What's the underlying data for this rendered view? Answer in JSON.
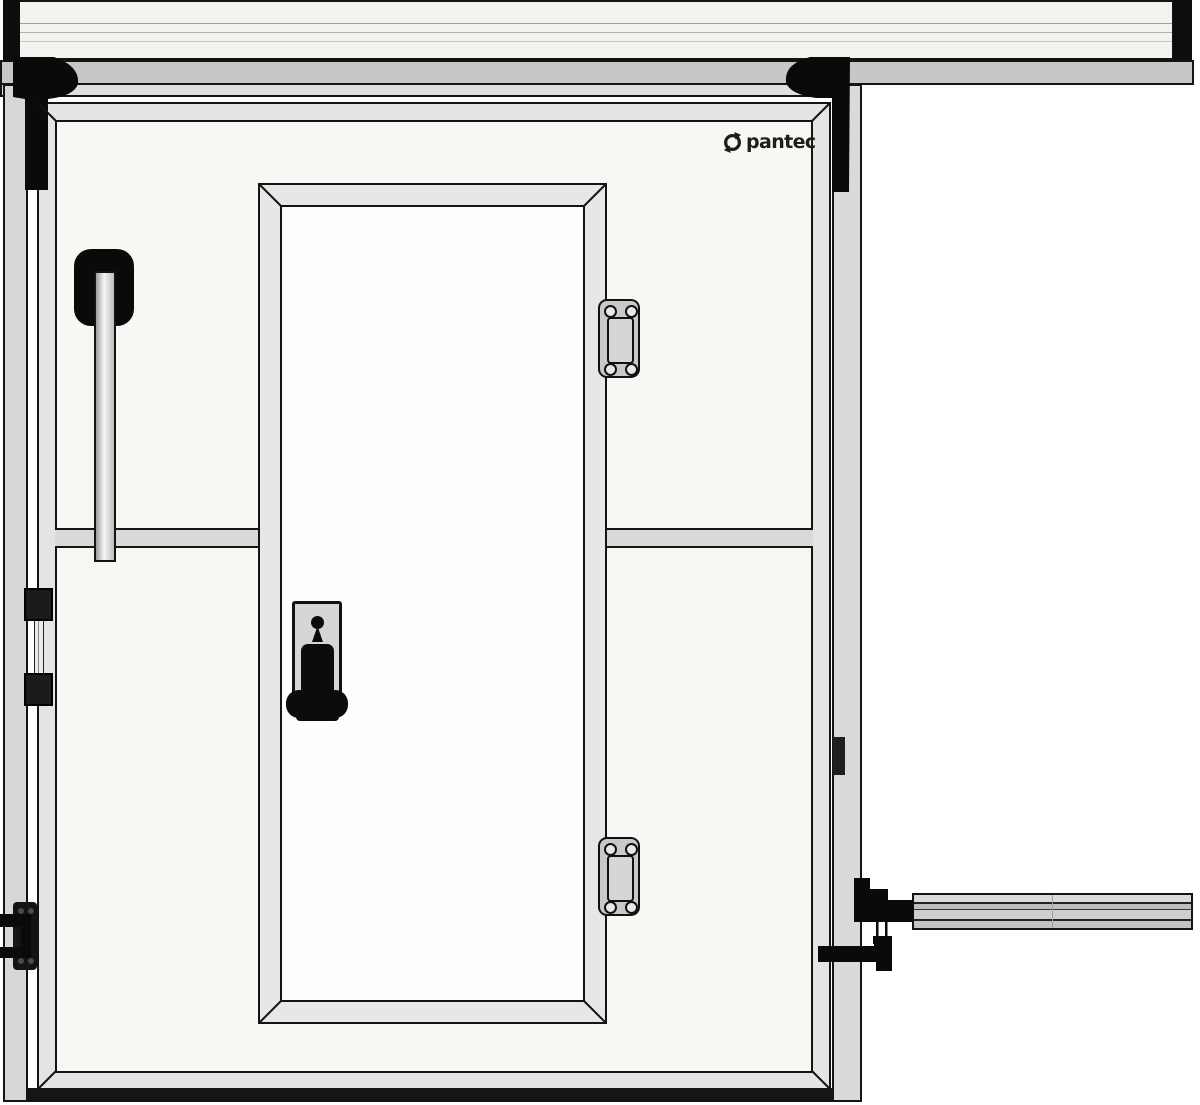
{
  "brand": {
    "logo_text": "pantec",
    "logo_icon": "circular-arrow-icon",
    "logo_color": "#1d1d1d"
  },
  "colors": {
    "background": "#ffffff",
    "outline": "#141414",
    "rail_beam": "#f3f3ef",
    "rail_end_caps": "#0d0d0d",
    "track_strip": "#c7c7c7",
    "track_strip_light": "#e0e0e0",
    "wall_jamb": "#d7d7d7",
    "guide_column": "#dadada",
    "panel_frame": "#e4e4e4",
    "panel_face": "#f7f7f4",
    "seam_strip": "#d9d9d9",
    "pass_door_frame": "#e7e7e7",
    "pass_door_leaf": "#fdfdfd",
    "hinge_metal": "#c9c9c9",
    "lock_plate": "#d6d6d6",
    "hardware_black": "#0c0c0c",
    "push_bar": "#cfcfcf",
    "floor_strip": "#151515"
  }
}
